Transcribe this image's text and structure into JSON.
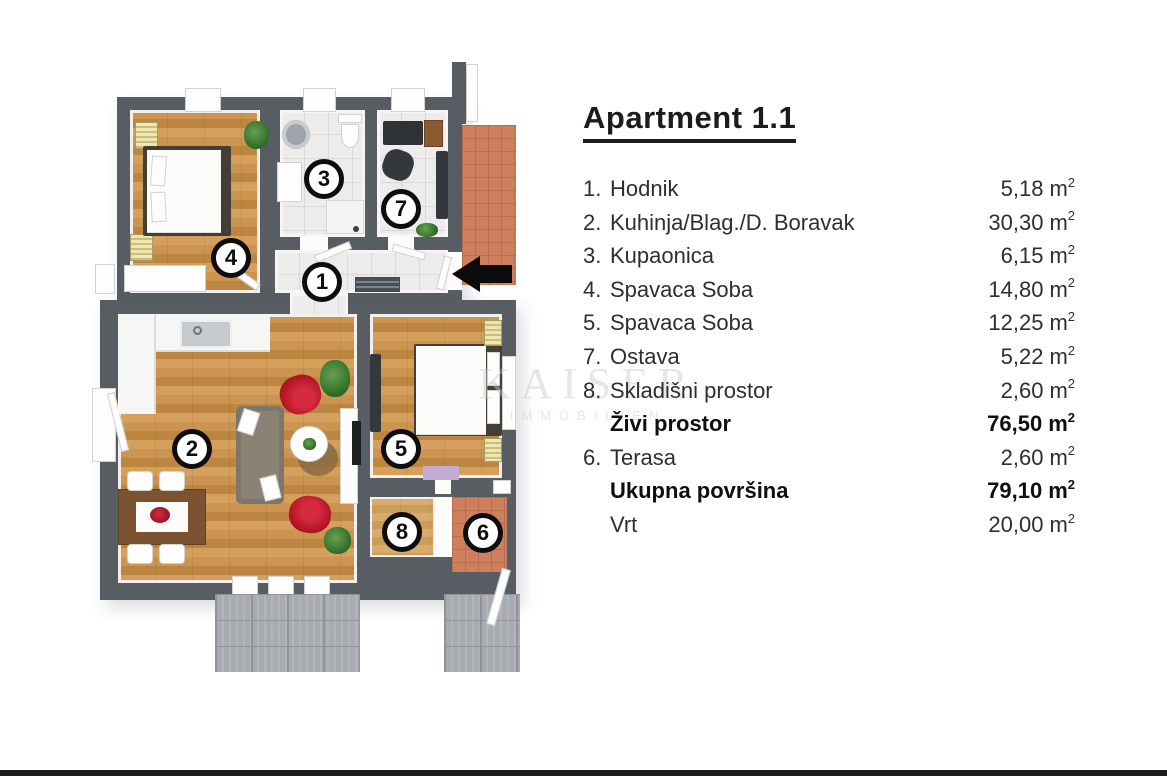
{
  "header": {
    "title": "Apartment 1.1"
  },
  "unit": {
    "base": "m",
    "exp": "2"
  },
  "area_rows": [
    {
      "num": "1.",
      "label": "Hodnik",
      "value": "5,18"
    },
    {
      "num": "2.",
      "label": "Kuhinja/Blag./D. Boravak",
      "value": "30,30"
    },
    {
      "num": "3.",
      "label": "Kupaonica",
      "value": "6,15"
    },
    {
      "num": "4.",
      "label": "Spavaca Soba",
      "value": "14,80"
    },
    {
      "num": "5.",
      "label": "Spavaca Soba",
      "value": "12,25"
    },
    {
      "num": "7.",
      "label": "Ostava",
      "value": "5,22"
    },
    {
      "num": "8.",
      "label": "Skladišni prostor",
      "value": "2,60"
    },
    {
      "num": "",
      "label": "Živi prostor",
      "value": "76,50"
    },
    {
      "num": "6.",
      "label": "Terasa",
      "value": "2,60"
    },
    {
      "num": "",
      "label": "Ukupna površina",
      "value": "79,10"
    },
    {
      "num": "",
      "label": "Vrt",
      "value": "20,00"
    }
  ],
  "plan": {
    "badges": [
      {
        "label": "4"
      },
      {
        "label": "3"
      },
      {
        "label": "7"
      },
      {
        "label": "1"
      },
      {
        "label": "2"
      },
      {
        "label": "5"
      },
      {
        "label": "8"
      },
      {
        "label": "6"
      }
    ],
    "entrance_arrow_direction": "left"
  },
  "watermark": {
    "line1": "KAISER",
    "line2": "IMMOBILIEN"
  },
  "palette": {
    "wall": "#585d64",
    "wood": "#c9944f",
    "tile": "#edecea",
    "brick": "#cd7f5e",
    "patio": "#a8acb1",
    "accent_red": "#c2192e",
    "radiator": "#e8dc9e",
    "text": "#2e2e2e"
  }
}
